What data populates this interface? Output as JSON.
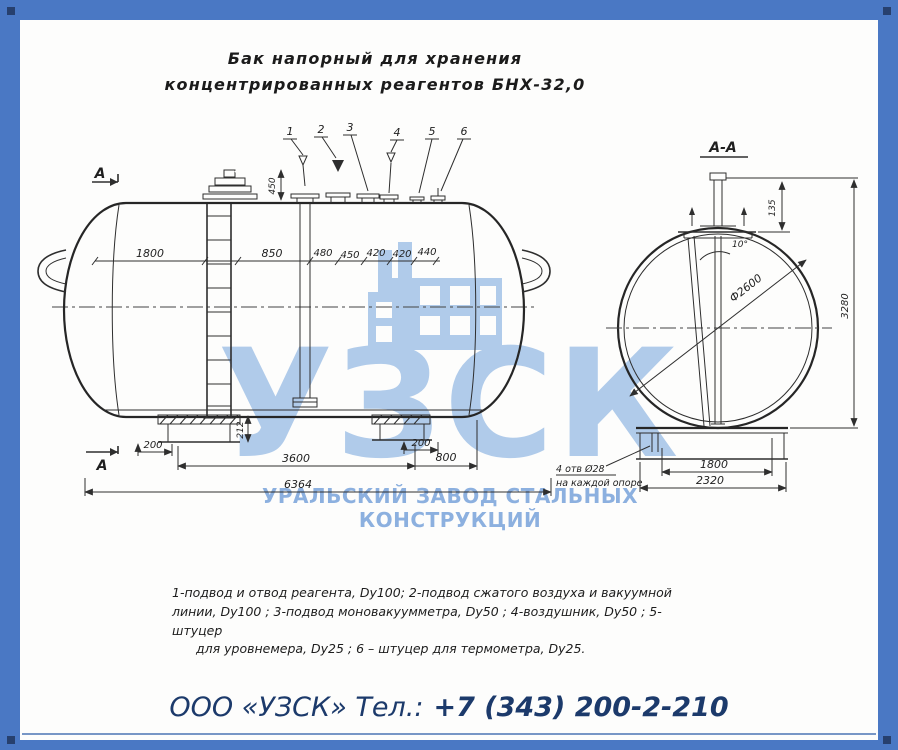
{
  "colors": {
    "border_blue": "#4a78c4",
    "corner_navy": "#27406e",
    "watermark_blue": "#b0cbea",
    "subtitle_blue": "#8cb0df",
    "footer_navy": "#1c3a6b",
    "line_dark": "#2e2e2e"
  },
  "title": {
    "line1": "Бак напорный для хранения",
    "line2": "концентрированных реагентов БНХ-32,0"
  },
  "watermark": {
    "logo": "УЗСК",
    "subtitle": "УРАЛЬСКИЙ ЗАВОД СТАЛЬНЫХ КОНСТРУКЦИЙ"
  },
  "footer": {
    "company": "ООО «УЗСК» Тел.:",
    "phone": "+7 (343) 200-2-210"
  },
  "main_view": {
    "section_label_top": "А",
    "section_label_bottom": "А",
    "callouts": [
      "1",
      "2",
      "3",
      "4",
      "5",
      "6"
    ],
    "dims": {
      "d1800": "1800",
      "d850": "850",
      "d480": "480",
      "d450": "450",
      "d420a": "420",
      "d420b": "420",
      "d440": "440",
      "nozzle_height": "450",
      "saddle_height": "212",
      "offset_left": "200",
      "offset_right": "200",
      "span": "3600",
      "end_span": "800",
      "overall_length": "6364"
    }
  },
  "section_view": {
    "title": "А-А",
    "diameter": "Ф2600",
    "angle": "10°",
    "stub_height": "135",
    "overall_height": "3280",
    "dims": {
      "base_inner": "1800",
      "base_overall": "2320"
    },
    "holes_note": {
      "line1": "4 отв Ø28",
      "line2": "на каждой опоре"
    }
  },
  "notes": {
    "line1": "1-подвод и отвод реагента, Dу100;  2-подвод сжатого воздуха и вакуумной",
    "line2": "линии, Dу100 ;  3-подвод моновакуумметра, Dу50 ;  4-воздушник, Dу50 ;  5- штуцер",
    "line3": "для уровнемера, Dу25 ; 6 – штуцер для термометра, Dу25."
  }
}
